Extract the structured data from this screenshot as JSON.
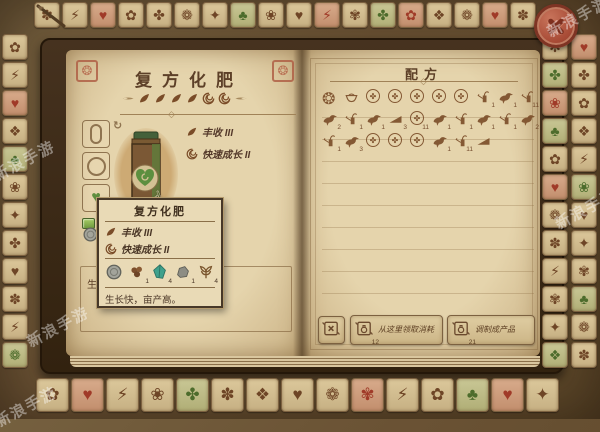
{
  "watermark": "新浪手游",
  "left_page": {
    "title": "复方化肥",
    "effects": [
      {
        "icon": "leaf",
        "label": "丰收 III"
      },
      {
        "icon": "swirl",
        "label": "快速成长 II"
      }
    ],
    "flourish": [
      "leaf",
      "leaf",
      "leaf",
      "leaf",
      "swirl",
      "swirl"
    ],
    "slots": [
      "capsule",
      "circle",
      "heart-leaf"
    ],
    "gems": [
      "gem",
      "gem"
    ],
    "page_items": [
      {
        "i": "coin-gray"
      },
      {
        "i": "berries"
      }
    ],
    "description": "生长快，亩产高。"
  },
  "tooltip": {
    "title": "复方化肥",
    "effects": [
      {
        "icon": "leaf",
        "label": "丰收 III"
      },
      {
        "icon": "swirl",
        "label": "快速成长 II"
      }
    ],
    "ingredients": [
      {
        "i": "coin-gray",
        "c": ""
      },
      {
        "i": "berries",
        "c": "1"
      },
      {
        "i": "crystal",
        "c": "4"
      },
      {
        "i": "stone",
        "c": "1"
      },
      {
        "i": "hemp",
        "c": "4"
      }
    ],
    "description": "生长快，亩产高。"
  },
  "right_page": {
    "title": "配方",
    "recipe_rows": [
      [
        {
          "i": "coin-stamp"
        },
        {
          "i": "bowl"
        },
        {
          "i": "medallion"
        },
        {
          "i": "medallion"
        },
        {
          "i": "medallion"
        },
        {
          "i": "medallion"
        },
        {
          "i": "medallion"
        },
        {
          "i": "can",
          "c": "1"
        },
        {
          "i": "bird",
          "c": "1"
        },
        {
          "i": "can",
          "c": "11"
        }
      ],
      [
        {
          "i": "bird",
          "c": "2"
        },
        {
          "i": "can",
          "c": "1"
        },
        {
          "i": "bird",
          "c": "1"
        },
        {
          "i": "plow",
          "c": "3"
        },
        {
          "i": "medallion",
          "c": "11"
        },
        {
          "i": "bird",
          "c": "1"
        },
        {
          "i": "can",
          "c": "1"
        },
        {
          "i": "bird",
          "c": "1"
        },
        {
          "i": "can",
          "c": "1"
        },
        {
          "i": "bird",
          "c": "2"
        }
      ],
      [
        {
          "i": "can",
          "c": "1"
        },
        {
          "i": "bird",
          "c": "3"
        },
        {
          "i": "medallion"
        },
        {
          "i": "medallion"
        },
        {
          "i": "medallion"
        },
        {
          "i": "bird",
          "c": "1"
        },
        {
          "i": "can",
          "c": "11"
        },
        {
          "i": "plow"
        }
      ]
    ],
    "buttons": [
      {
        "icon": "scroll-x",
        "badge": "",
        "label": ""
      },
      {
        "icon": "scroll-flask",
        "badge": "12",
        "label": "从这里领取消耗"
      },
      {
        "icon": "scroll-flask",
        "badge": "21",
        "label": "调制成产品"
      }
    ]
  },
  "border": {
    "top": [
      {
        "i": "petal"
      },
      {
        "i": "lightning"
      },
      {
        "i": "heart",
        "t": "red"
      },
      {
        "i": "flower"
      },
      {
        "i": "sparkle"
      },
      {
        "i": "daisy"
      },
      {
        "i": "star"
      },
      {
        "i": "clover",
        "t": "green"
      },
      {
        "i": "blossom"
      },
      {
        "i": "heart"
      },
      {
        "i": "lightning",
        "t": "red"
      },
      {
        "i": "bloom"
      },
      {
        "i": "sparkle",
        "t": "green"
      },
      {
        "i": "flower",
        "t": "red"
      },
      {
        "i": "gem"
      },
      {
        "i": "daisy"
      },
      {
        "i": "heart",
        "t": "red"
      },
      {
        "i": "petal"
      }
    ],
    "left": [
      {
        "i": "flower"
      },
      {
        "i": "lightning"
      },
      {
        "i": "heart",
        "t": "red"
      },
      {
        "i": "gem"
      },
      {
        "i": "clover",
        "t": "green"
      },
      {
        "i": "blossom"
      },
      {
        "i": "star"
      },
      {
        "i": "sparkle"
      },
      {
        "i": "heart"
      },
      {
        "i": "petal"
      },
      {
        "i": "lightning"
      },
      {
        "i": "daisy",
        "t": "green"
      }
    ],
    "right_inner": [
      {
        "i": "snowflake"
      },
      {
        "i": "sparkle",
        "t": "green"
      },
      {
        "i": "blossom",
        "t": "red"
      },
      {
        "i": "clover",
        "t": "green"
      },
      {
        "i": "flower"
      },
      {
        "i": "heart",
        "t": "red"
      },
      {
        "i": "daisy"
      },
      {
        "i": "petal"
      },
      {
        "i": "lightning"
      },
      {
        "i": "bloom"
      },
      {
        "i": "star"
      },
      {
        "i": "gem",
        "t": "green"
      }
    ],
    "right_outer": [
      {
        "i": "heart",
        "t": "red"
      },
      {
        "i": "sparkle"
      },
      {
        "i": "flower"
      },
      {
        "i": "gem"
      },
      {
        "i": "lightning"
      },
      {
        "i": "blossom",
        "t": "green"
      },
      {
        "i": "heart"
      },
      {
        "i": "star"
      },
      {
        "i": "bloom"
      },
      {
        "i": "clover",
        "t": "green"
      },
      {
        "i": "daisy"
      },
      {
        "i": "petal"
      }
    ],
    "bottom": [
      {
        "i": "flower"
      },
      {
        "i": "heart",
        "t": "red"
      },
      {
        "i": "lightning"
      },
      {
        "i": "blossom"
      },
      {
        "i": "sparkle",
        "t": "green"
      },
      {
        "i": "petal"
      },
      {
        "i": "gem"
      },
      {
        "i": "heart"
      },
      {
        "i": "daisy"
      },
      {
        "i": "bloom",
        "t": "red"
      },
      {
        "i": "lightning"
      },
      {
        "i": "flower"
      },
      {
        "i": "clover",
        "t": "green"
      },
      {
        "i": "heart",
        "t": "red"
      },
      {
        "i": "star"
      }
    ]
  }
}
